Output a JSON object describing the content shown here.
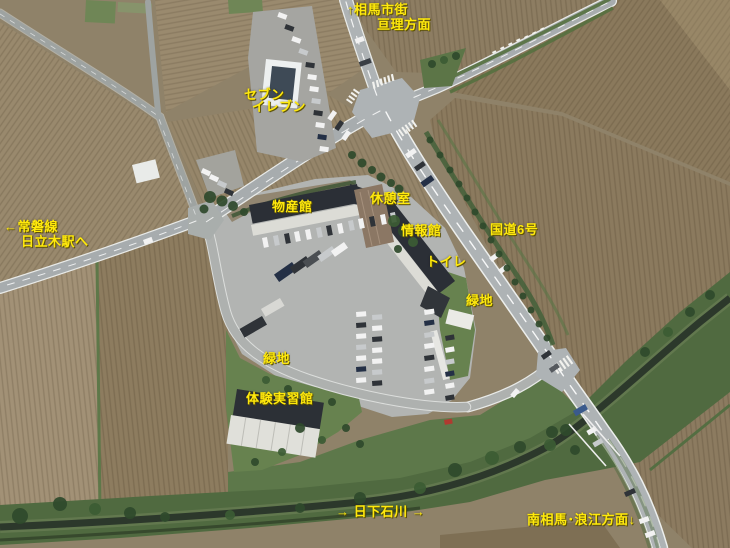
{
  "map": {
    "annotation_color": "#ffe90c",
    "labels": [
      {
        "id": "direction-north-soma",
        "text": "↑相馬市街",
        "x": 347,
        "y": 3
      },
      {
        "id": "direction-north-watari",
        "text": "亘理方面",
        "x": 377,
        "y": 18
      },
      {
        "id": "seven-eleven-line1",
        "text": "セブン",
        "x": 244,
        "y": 88
      },
      {
        "id": "seven-eleven-line2",
        "text": "イレブン",
        "x": 252,
        "y": 100
      },
      {
        "id": "bussankan",
        "text": "物産館",
        "x": 272,
        "y": 200
      },
      {
        "id": "kyukeishitsu",
        "text": "休憩室",
        "x": 370,
        "y": 192
      },
      {
        "id": "johokan",
        "text": "情報館",
        "x": 401,
        "y": 224
      },
      {
        "id": "kokudo-6-go",
        "text": "国道6号",
        "x": 490,
        "y": 223
      },
      {
        "id": "toire",
        "text": "トイレ",
        "x": 426,
        "y": 255
      },
      {
        "id": "ryokuchi-east",
        "text": "緑地",
        "x": 466,
        "y": 294
      },
      {
        "id": "joban-line",
        "text": "←常磐線",
        "x": 4,
        "y": 220
      },
      {
        "id": "hitachiki-station",
        "text": "日立木駅へ",
        "x": 21,
        "y": 235
      },
      {
        "id": "ryokuchi-south",
        "text": "緑地",
        "x": 263,
        "y": 352
      },
      {
        "id": "taiken-jisshukan",
        "text": "体験実習館",
        "x": 246,
        "y": 392
      },
      {
        "id": "nikkeishi-river",
        "text": "→ 日下石川 →",
        "x": 336,
        "y": 505
      },
      {
        "id": "direction-south",
        "text": "南相馬･浪江方面↓",
        "x": 527,
        "y": 513
      }
    ],
    "palette": {
      "label_yellow": "#ffe90c",
      "field_brown": "#97876c",
      "field_dark": "#8a795c",
      "field_light": "#a39377",
      "road_gray": "#a8adaf",
      "grass_green": "#64804e",
      "river_bank": "#506a40",
      "river_channel": "#2c382b",
      "roof_dark": "#2b2f36",
      "roof_white": "#e0e0da"
    }
  }
}
